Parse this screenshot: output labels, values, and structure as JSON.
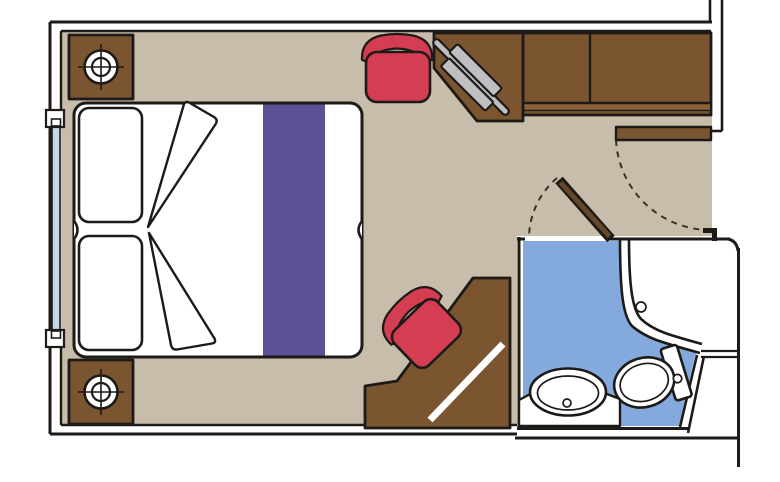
{
  "diagram": {
    "type": "floor-plan",
    "subject": "cruise-cabin-stateroom-with-bathroom"
  },
  "colors": {
    "background": "#ffffff",
    "white": "#ffffff",
    "wall_ink": "#1d1a17",
    "floor_tan": "#c8bcaa",
    "wood_brown": "#7b5530",
    "wood_shelf": "#8a6138",
    "door_leaf_brown": "#63492a",
    "upholstery_red": "#d43d52",
    "runner_purple": "#5b5295",
    "bath_floor_blue": "#84a9dc",
    "mirror_gray": "#bfbfc3",
    "window_glass": "#c5d8e4"
  },
  "items": {
    "bed": "double-bed-with-purple-runner",
    "pillow_count": 2,
    "nightstand_count": 2,
    "nightstand_symbol": "lamp-crosshair",
    "wardrobe": "two-door-wardrobe",
    "vanity": "vanity-desk-with-mirror",
    "stool": "red-stool",
    "chair": "red-chair",
    "corner_desk": "angled-writing-desk",
    "window": "left-wall-window",
    "entry_door": "hinged-door-open-with-swing-arc",
    "bathroom_door": "hinged-door-ajar-with-swing-arc",
    "bathroom_fixtures": [
      "washbasin",
      "toilet",
      "shower"
    ]
  }
}
